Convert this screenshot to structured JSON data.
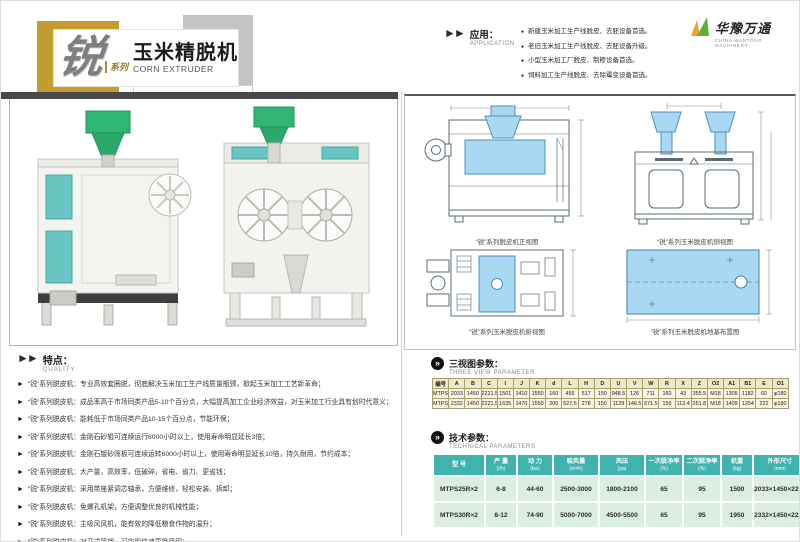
{
  "icons": {
    "section_arrow": "►►",
    "circle_chevron": "»",
    "bullet": "●",
    "feature_arrow": "►"
  },
  "title_block": {
    "series_char": "锐",
    "series_label": "系列",
    "title": "玉米精脱机",
    "subtitle": "CORN EXTRUDER"
  },
  "logo": {
    "name": "华豫万通",
    "name_en": "CHINA WANTONG MACHINERY"
  },
  "application": {
    "label": "应用：",
    "label_en": "APPLICATION",
    "items": [
      "新建玉米加工生产线脱皮、去胚设备首选。",
      "老旧玉米加工生产线脱皮、去胚设备升级。",
      "小型玉米加工厂脱皮、制糁设备首选。",
      "饲料加工生产线脱皮、去除霉变设备首选。"
    ]
  },
  "features": {
    "label": "特点：",
    "label_en": "QUALITY",
    "items": [
      "“锐”系列脱皮机：专业高效套圈脱，彻底解决玉米加工生产线质量瓶颈，掀起玉米加工工艺新革命；",
      "“锐”系列脱皮机：成品率高于市场同类产品5-10个百分点，大幅提高加工企业经济效益，对玉米加工行业具有划时代意义；",
      "“锐”系列脱皮机：能耗低于市场同类产品10-15个百分点，节能环保；",
      "“锐”系列脱皮机：金刚石砂辊可连续运行8000小时以上，使用寿命明显延长3倍；",
      "“锐”系列脱皮机：金刚石镀砂筛板可连续运转6000小时以上，使用寿命明显延长10倍，持久耐用，节约成本；",
      "“锐”系列脱皮机：大产量，高效率，低破碎，省电、省力、更省钱；",
      "“锐”系列脱皮机：采用带座紧调芯轴承，方便维修，轻松安装、拆卸；",
      "“锐”系列脱皮机：免螺孔机架，方便调整优良的机械性能；",
      "“锐”系列脱皮机：主吸风风机，能有效的降低粮食作物的温升；",
      "“锐”系列脱皮机：对开式筛架，可实现快速更换筛网；"
    ]
  },
  "views": {
    "captions": [
      "“锐”系列脱皮机正视图",
      "“锐”系列玉米脱皮机侧视图",
      "“锐”系列玉米脱皮机俯视图",
      "“锐”系列玉米脱皮机地基布置图"
    ]
  },
  "three_view": {
    "label": "三视图参数：",
    "label_en": "THREE VIEW PARAMETER",
    "columns": [
      "编号",
      "A",
      "B",
      "C",
      "I",
      "J",
      "K",
      "d",
      "L",
      "H",
      "D",
      "U",
      "V",
      "W",
      "R",
      "X",
      "Z",
      "O2",
      "A1",
      "B1",
      "E",
      "O1"
    ],
    "rows": [
      [
        "MTPS-25R×2",
        "2033",
        "1450",
        "2221.5",
        "1501",
        "1410",
        "1550",
        "160",
        "455",
        "517",
        "150",
        "948.5",
        "126",
        "711",
        "160",
        "43",
        "355.5",
        "M18",
        "1305",
        "1182",
        "60",
        "φ180"
      ],
      [
        "MTPS-30R×2",
        "2332",
        "1450",
        "2221.5",
        "1635",
        "1470",
        "1550",
        "200",
        "527.5",
        "278",
        "150",
        "1129",
        "146.5",
        "671.5",
        "150",
        "113.4",
        "251.8",
        "M18",
        "1409",
        "1254",
        "222",
        "φ180"
      ]
    ]
  },
  "tech": {
    "label": "技术参数：",
    "label_en": "TECHNICAL PARAMETERS",
    "headers": [
      {
        "label": "型  号",
        "unit": ""
      },
      {
        "label": "产  量",
        "unit": "(t/h)"
      },
      {
        "label": "动  力",
        "unit": "(kw)"
      },
      {
        "label": "吸风量",
        "unit": "(m³/h)"
      },
      {
        "label": "风压",
        "unit": "(pa)"
      },
      {
        "label": "一次脱净率",
        "unit": "(%)"
      },
      {
        "label": "二次脱净率",
        "unit": "(%)"
      },
      {
        "label": "机重",
        "unit": "(kg)"
      },
      {
        "label": "外形尺寸",
        "unit": "(mm)"
      }
    ],
    "rows": [
      [
        "MTPS25R×2",
        "6-8",
        "44-60",
        "2500-3000",
        "1800-2100",
        "65",
        "95",
        "1500",
        "2033×1450×2222"
      ],
      [
        "MTPS30R×2",
        "8-12",
        "74-90",
        "5000-7000",
        "4500-5500",
        "65",
        "95",
        "1950",
        "2332×1450×2222"
      ]
    ]
  }
}
